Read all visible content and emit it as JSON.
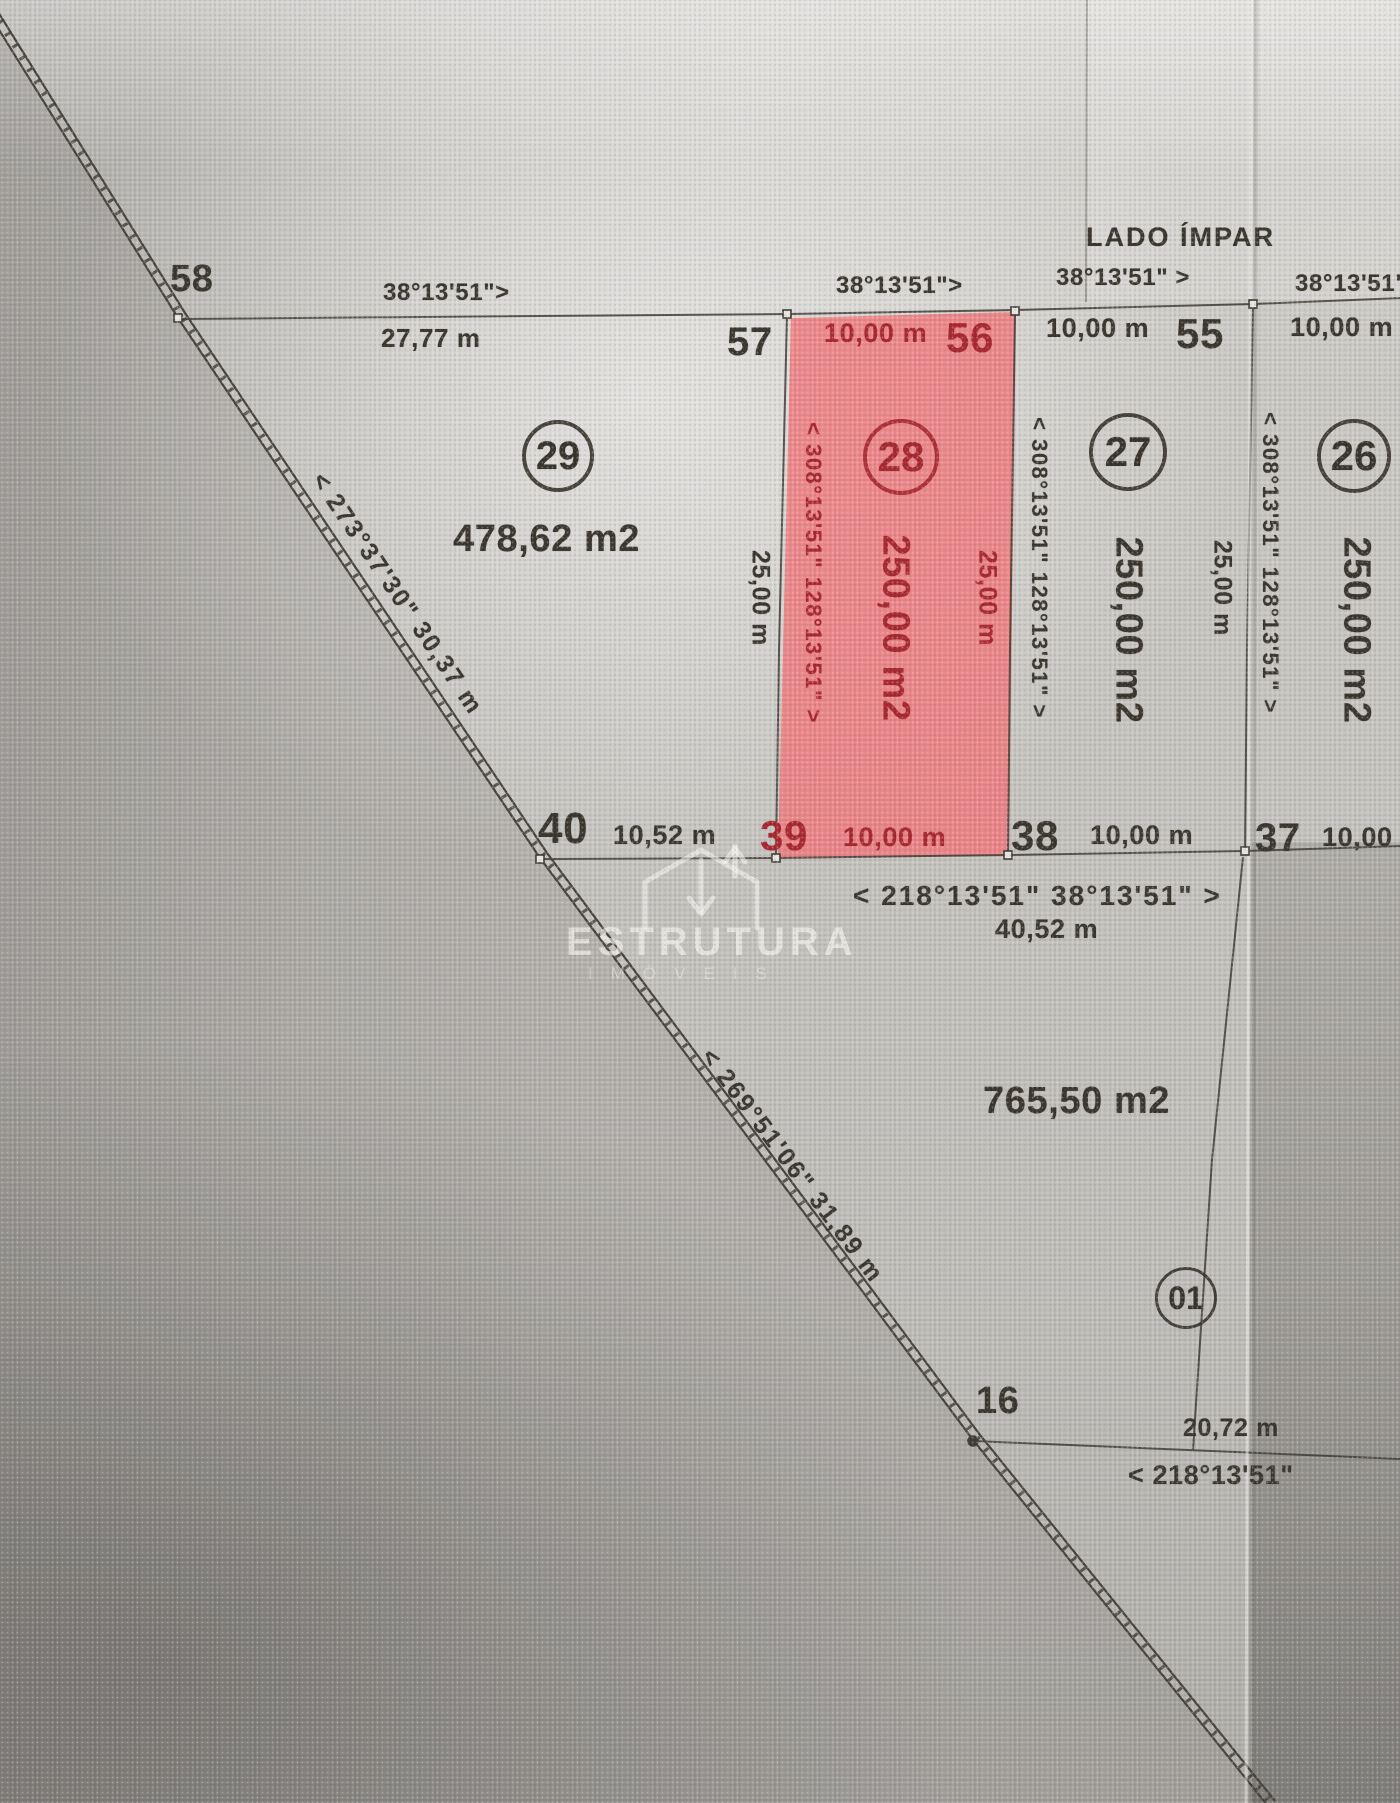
{
  "street_label": "LADO ÍMPAR",
  "vertices": {
    "v58": "58",
    "v57": "57",
    "v56": "56",
    "v55": "55",
    "v40": "40",
    "v39": "39",
    "v38": "38",
    "v37": "37",
    "v16": "16"
  },
  "front_segments": {
    "s1": {
      "bearing": "38°13'51\">",
      "length": "27,77 m"
    },
    "s2": {
      "bearing": "38°13'51\">",
      "length": "10,00 m"
    },
    "s3": {
      "bearing": "38°13'51\" >",
      "length": "10,00 m"
    },
    "s4": {
      "bearing": "38°13'51\"",
      "length": "10,00 m"
    }
  },
  "back_segments": {
    "s40_39": "10,52 m",
    "s39_38": "10,00 m",
    "s38_37": "10,00 m",
    "s37_36": "10,00"
  },
  "lots": {
    "lot29": {
      "number": "29",
      "area": "478,62 m2",
      "side_length": "25,00 m"
    },
    "lot28": {
      "number": "28",
      "area": "250,00 m2",
      "side_length": "25,00 m",
      "side_bearing": "< 308°13'51\" 128°13'51\" >"
    },
    "lot27": {
      "number": "27",
      "area": "250,00 m2",
      "side_length": "25,00 m",
      "side_bearing": "< 308°13'51\" 128°13'51\" >"
    },
    "lot26": {
      "number": "26",
      "area": "250,00 m2",
      "side_bearing": "< 308°13'51\" 128°13'51\" >"
    },
    "lot01": {
      "number": "01"
    },
    "remainder": {
      "area": "765,50 m2",
      "front_bearing": "< 218°13'51\" 38°13'51\" >",
      "front_length": "40,52 m",
      "south_length": "20,72 m",
      "south_bearing": "< 218°13'51\""
    }
  },
  "road_labels": {
    "segment1": "< 273°37'30\" 30,37 m",
    "segment2": "< 269°51'06\" 31,89 m"
  },
  "watermark": {
    "title": "ESTRUTURA",
    "subtitle": "IMÓVEIS"
  },
  "colors": {
    "highlight": "#f1797e",
    "highlight_ink": "#a8262e",
    "ink": "#38342c"
  }
}
